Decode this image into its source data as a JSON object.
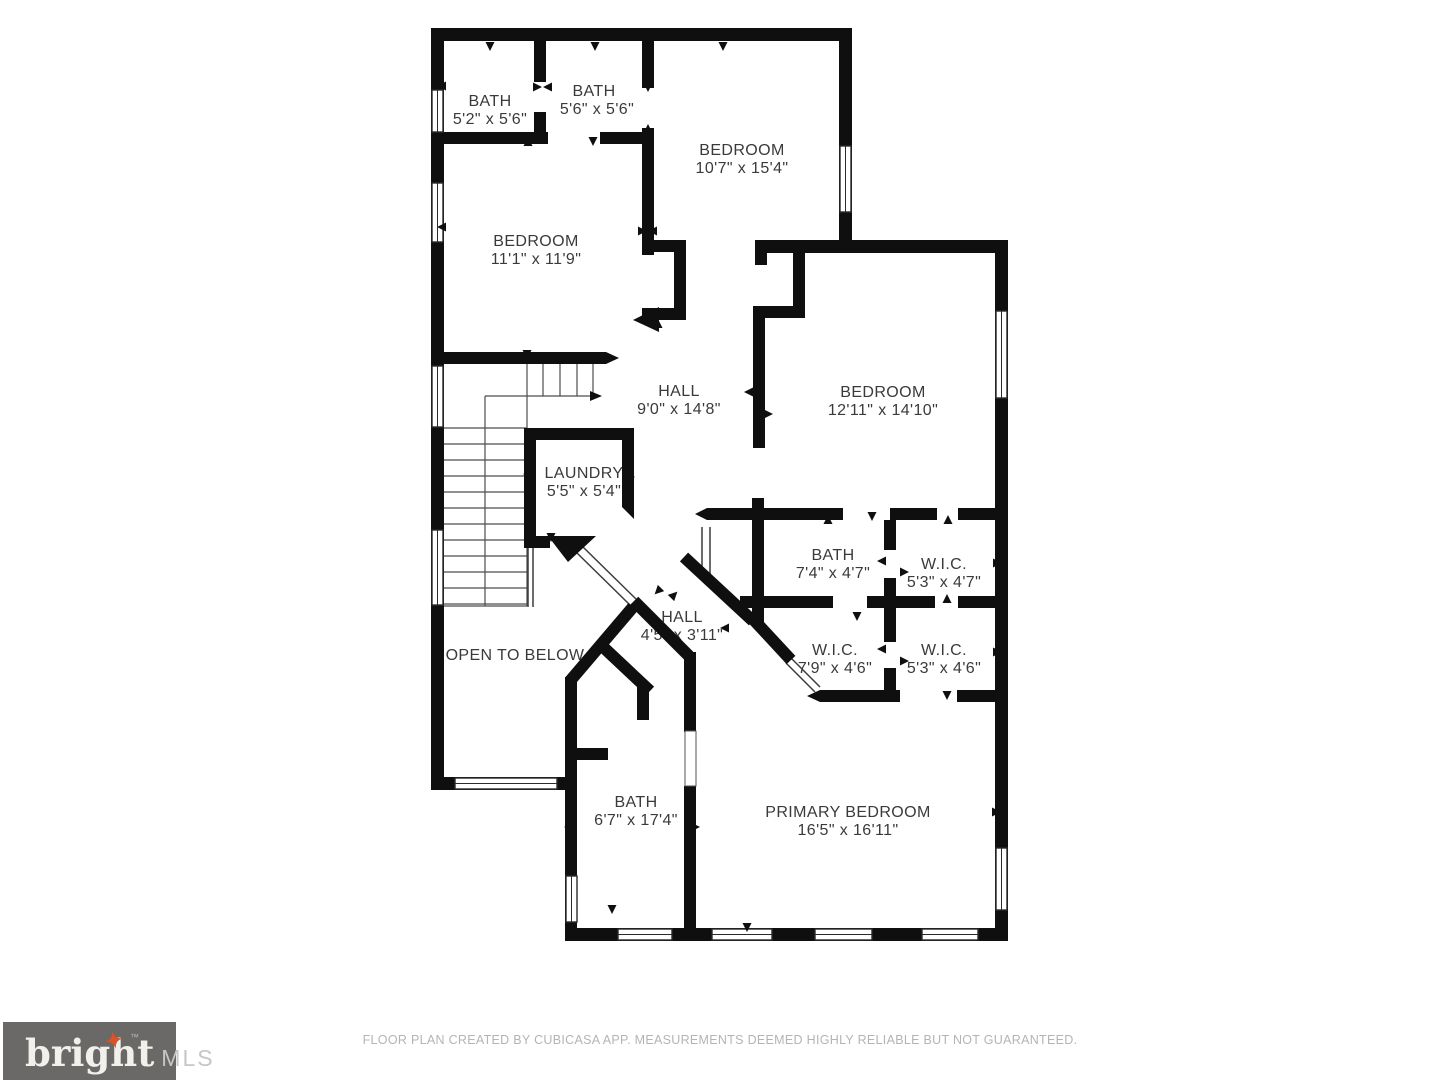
{
  "plan": {
    "wall_color": "#0f0f0f",
    "label_color": "#3a3a3a",
    "rooms": [
      {
        "name": "BATH",
        "dims": "5'2\" x 5'6\""
      },
      {
        "name": "BATH",
        "dims": "5'6\" x 5'6\""
      },
      {
        "name": "BEDROOM",
        "dims": "10'7\" x 15'4\""
      },
      {
        "name": "BEDROOM",
        "dims": "11'1\" x 11'9\""
      },
      {
        "name": "HALL",
        "dims": "9'0\" x 14'8\""
      },
      {
        "name": "BEDROOM",
        "dims": "12'11\" x 14'10\""
      },
      {
        "name": "LAUNDRY",
        "dims": "5'5\" x 5'4\""
      },
      {
        "name": "BATH",
        "dims": "7'4\" x 4'7\""
      },
      {
        "name": "W.I.C.",
        "dims": "5'3\" x 4'7\""
      },
      {
        "name": "HALL",
        "dims": "4'5\" x 3'11\""
      },
      {
        "name": "W.I.C.",
        "dims": "7'9\" x 4'6\""
      },
      {
        "name": "W.I.C.",
        "dims": "5'3\" x 4'6\""
      },
      {
        "name": "OPEN TO BELOW",
        "dims": ""
      },
      {
        "name": "BATH",
        "dims": "6'7\" x 17'4\""
      },
      {
        "name": "PRIMARY BEDROOM",
        "dims": "16'5\" x 16'11\""
      }
    ]
  },
  "footer": {
    "disclaimer": "FLOOR PLAN CREATED BY CUBICASA APP. MEASUREMENTS DEEMED HIGHLY RELIABLE BUT NOT GUARANTEED.",
    "logo": {
      "brand": "bright",
      "tm": "™",
      "suffix": "MLS",
      "box_color": "#6a6967",
      "star_color": "#dd5226"
    }
  }
}
